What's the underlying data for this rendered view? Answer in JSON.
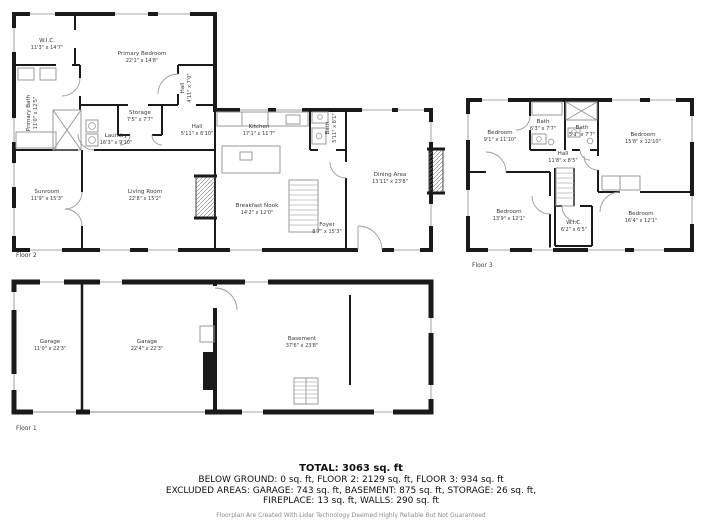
{
  "floors": {
    "floor2": {
      "label": "Floor 2",
      "rooms": [
        {
          "name": "W.I.C.",
          "dims": "11'3\" x 14'7\""
        },
        {
          "name": "Primary Bedroom",
          "dims": "22'1\" x 14'8\""
        },
        {
          "name": "Hall",
          "dims": "4'11\" x 7'0\""
        },
        {
          "name": "Primary Bath",
          "dims": "11'0\" x 12'5\""
        },
        {
          "name": "Storage",
          "dims": "7'5\" x 7'7\""
        },
        {
          "name": "Laundry",
          "dims": "16'3\" x 9'10\""
        },
        {
          "name": "Hall",
          "dims": "5'11\" x 6'10\""
        },
        {
          "name": "Kitchen",
          "dims": "17'1\" x 11'7\""
        },
        {
          "name": "Bath",
          "dims": "5'11\" x 8'1\""
        },
        {
          "name": "Sunroom",
          "dims": "11'9\" x 15'3\""
        },
        {
          "name": "Living Room",
          "dims": "22'8\" x 15'2\""
        },
        {
          "name": "Breakfast Nook",
          "dims": "14'2\" x 12'0\""
        },
        {
          "name": "Dining Area",
          "dims": "13'11\" x 23'8\""
        },
        {
          "name": "Foyer",
          "dims": "8'7\" x 15'3\""
        }
      ]
    },
    "floor3": {
      "label": "Floor 3",
      "rooms": [
        {
          "name": "Bedroom",
          "dims": "9'1\" x 11'10\""
        },
        {
          "name": "Bath",
          "dims": "6'3\" x 7'7\""
        },
        {
          "name": "Bath",
          "dims": "5'1\" x 7'7\""
        },
        {
          "name": "Bedroom",
          "dims": "15'8\" x 12'10\""
        },
        {
          "name": "Hall",
          "dims": "11'8\" x 8'5\""
        },
        {
          "name": "Bedroom",
          "dims": "13'9\" x 12'1\""
        },
        {
          "name": "W.I.C.",
          "dims": "6'2\" x 6'5\""
        },
        {
          "name": "Bedroom",
          "dims": "16'4\" x 12'1\""
        }
      ]
    },
    "floor1": {
      "label": "Floor 1",
      "rooms": [
        {
          "name": "Garage",
          "dims": "11'0\" x 22'3\""
        },
        {
          "name": "Garage",
          "dims": "22'4\" x 22'3\""
        },
        {
          "name": "Basement",
          "dims": "37'6\" x 23'8\""
        }
      ]
    }
  },
  "summary": {
    "total": "TOTAL: 3063 sq. ft",
    "line1": "BELOW GROUND: 0 sq. ft, FLOOR 2: 2129 sq. ft, FLOOR 3: 934 sq. ft",
    "line2": "EXCLUDED AREAS: GARAGE: 743 sq. ft, BASEMENT: 875 sq. ft, STORAGE: 26 sq. ft,",
    "line3": "FIREPLACE: 13 sq. ft, WALLS: 290 sq. ft"
  },
  "disclaimer": "Floorplan Are Created With Lidar Technology Deemed Highly Reliable But Not Guaranteed",
  "colors": {
    "wall": "#1a1a1a",
    "fixture": "#999999",
    "label": "#3a3a3a",
    "background": "#ffffff"
  }
}
